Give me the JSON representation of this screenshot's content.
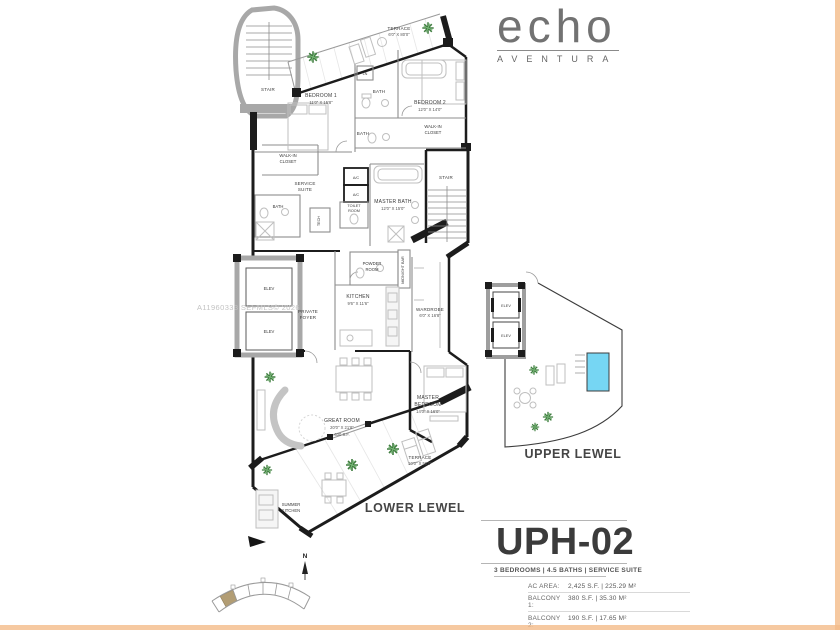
{
  "logo": {
    "brand": "echo",
    "subbrand": "AVENTURA"
  },
  "watermark": "A11960333 SEFMLS© 2026",
  "plan": {
    "lower": {
      "caption": "LOWER LEWEL",
      "rooms": {
        "terrace_top": {
          "name": "TERRACE",
          "dims": "6'0\" X 80'0\""
        },
        "stair_top": "STAIR",
        "bedroom1": {
          "name": "BEDROOM 1",
          "dims": "11'0\" X 15'8\""
        },
        "bath1": "BATH",
        "ln": "LN",
        "bedroom2": {
          "name": "BEDROOM 2",
          "dims": "12'0\" X 14'0\""
        },
        "walkin_right": {
          "l1": "WALK-IN",
          "l2": "CLOSET"
        },
        "bath2": "BATH",
        "walkin_left": {
          "l1": "WALK-IN",
          "l2": "CLOSET"
        },
        "service_suite": {
          "l1": "SERVICE",
          "l2": "SUITE"
        },
        "bath3": "BATH",
        "ac": "A/C",
        "toilet_room": {
          "l1": "TOILET",
          "l2": "ROOM"
        },
        "master_bath": {
          "name": "MASTER BATH",
          "dims": "12'0\" X 15'0\""
        },
        "stair_mid": "STAIR",
        "tech": "TECH",
        "powder": {
          "l1": "POWDER",
          "l2": "ROOM"
        },
        "midnight_bar": "MIDNIGHT BAR",
        "kitchen": {
          "name": "KITCHEN",
          "dims": "9'6\" X 11'6\""
        },
        "foyer": {
          "l1": "PRIVATE",
          "l2": "FOYER"
        },
        "elev": "ELEV",
        "wardrobe": {
          "name": "WARDROBE",
          "dims": "6'0\" X 16'8\""
        },
        "great_room": {
          "name": "GREAT ROOM",
          "dims": "20'0\" X 21'8\"",
          "area": "630 S.F."
        },
        "master_bedroom": {
          "l1": "MASTER",
          "l2": "BEDROOM",
          "dims": "14'0\" X 16'0\""
        },
        "terrace_lower": {
          "name": "TERRACE",
          "dims": "10'0\" X 50'0\""
        },
        "summer_kitchen": {
          "l1": "SUMMER",
          "l2": "KITCHEN"
        }
      }
    },
    "upper": {
      "caption": "UPPER LEWEL",
      "elev": "ELEV"
    },
    "compass_north": "N"
  },
  "unit": {
    "title": "UPH-02",
    "summary": "3 BEDROOMS | 4.5 BATHS | SERVICE SUITE",
    "stats": [
      {
        "label": "AC AREA:",
        "value": "2,425 S.F. | 225.29 M²"
      },
      {
        "label": "BALCONY 1:",
        "value": "380 S.F. | 35.30 M²"
      },
      {
        "label": "BALCONY 2:",
        "value": "190 S.F. | 17.65 M²"
      },
      {
        "label": "TOTAL:",
        "value": "2,995 S.F. | 278.24 M²"
      }
    ]
  },
  "colors": {
    "pool": "#76d6f3",
    "unit_highlight": "#b29d74",
    "plant_green": "#3e7d3e",
    "edge_tint": "#f4bb8a"
  }
}
